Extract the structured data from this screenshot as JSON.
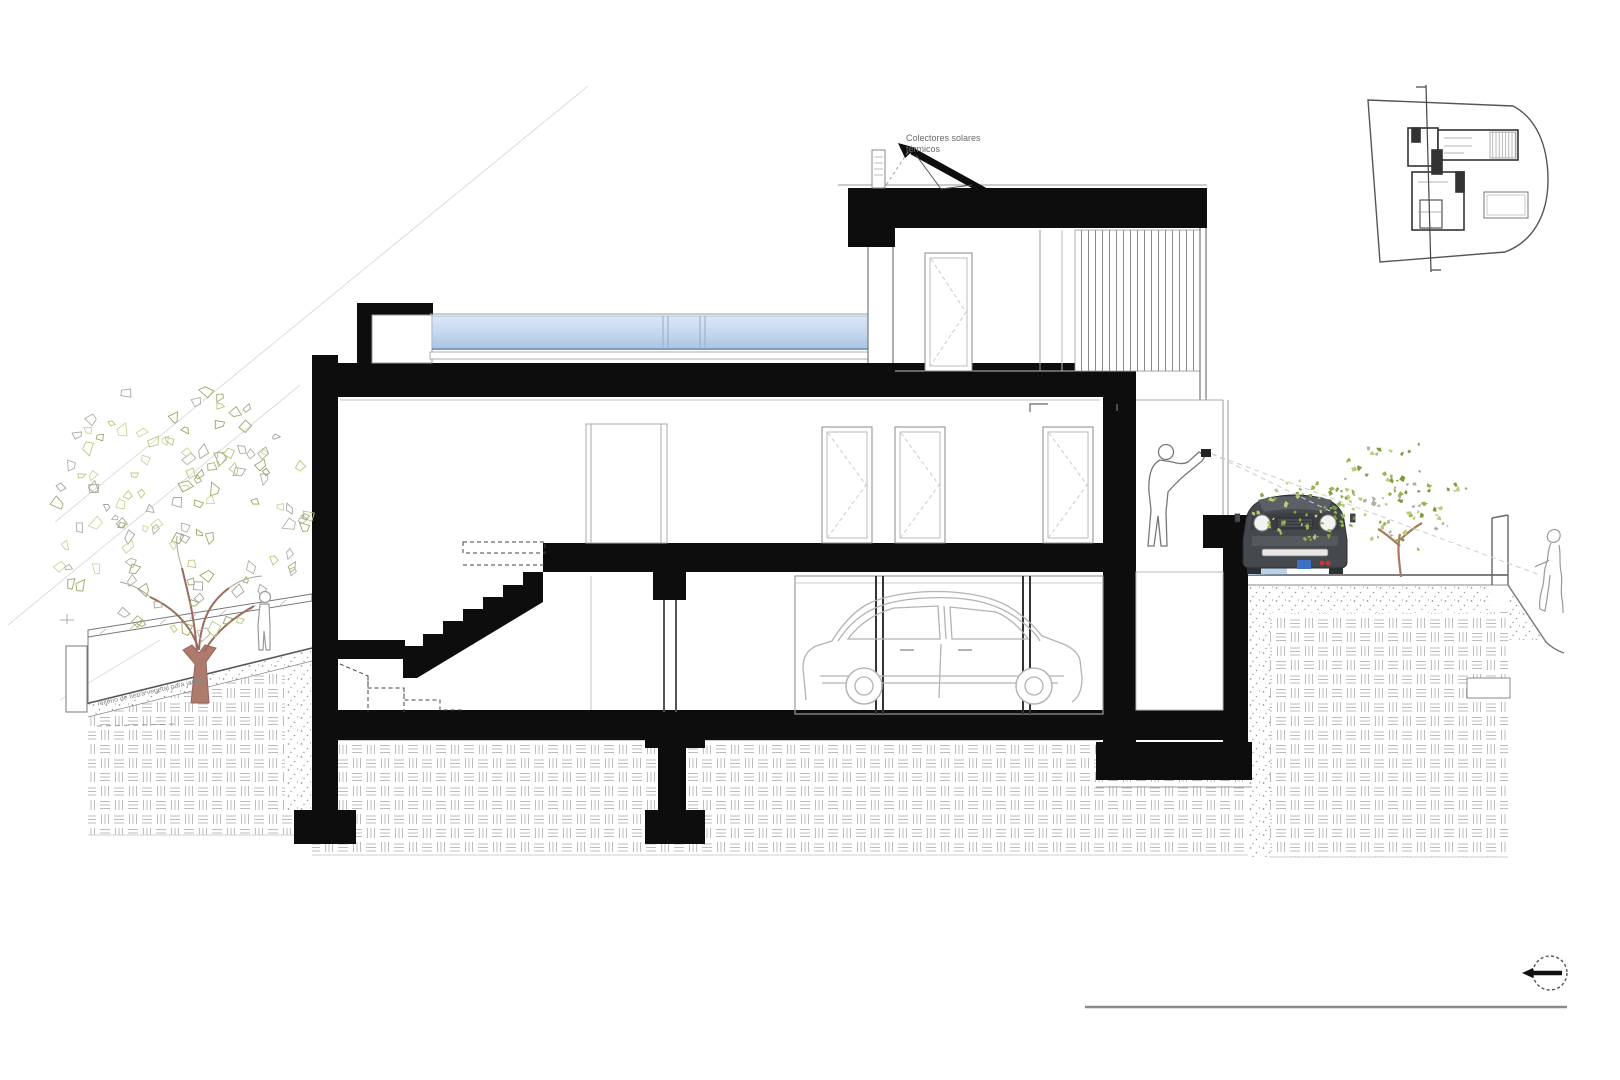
{
  "page": {
    "background": "#ffffff"
  },
  "drawing": {
    "annotations": {
      "solar_line1": "Colectores solares",
      "solar_line2": "térmicos",
      "ground_note": "relleno de tierra vegetal para jardin"
    },
    "colors": {
      "ink": "#0d0d0d",
      "line_gray": "#999999",
      "hatch_gray": "#bcbcbc",
      "skylight_top": "#dbe8f7",
      "skylight_bottom": "#a9c4e4",
      "shadow_blue": "#bad2ea",
      "foliage_green": "#b6c97e",
      "foliage_dark": "#8fa557",
      "trunk_brown": "#ad7a6c",
      "car_body": "#45494d"
    },
    "icons": {
      "section_marker": "circle-left-arrow-icon",
      "site_plan_cut_line": "section-cut-line"
    }
  }
}
